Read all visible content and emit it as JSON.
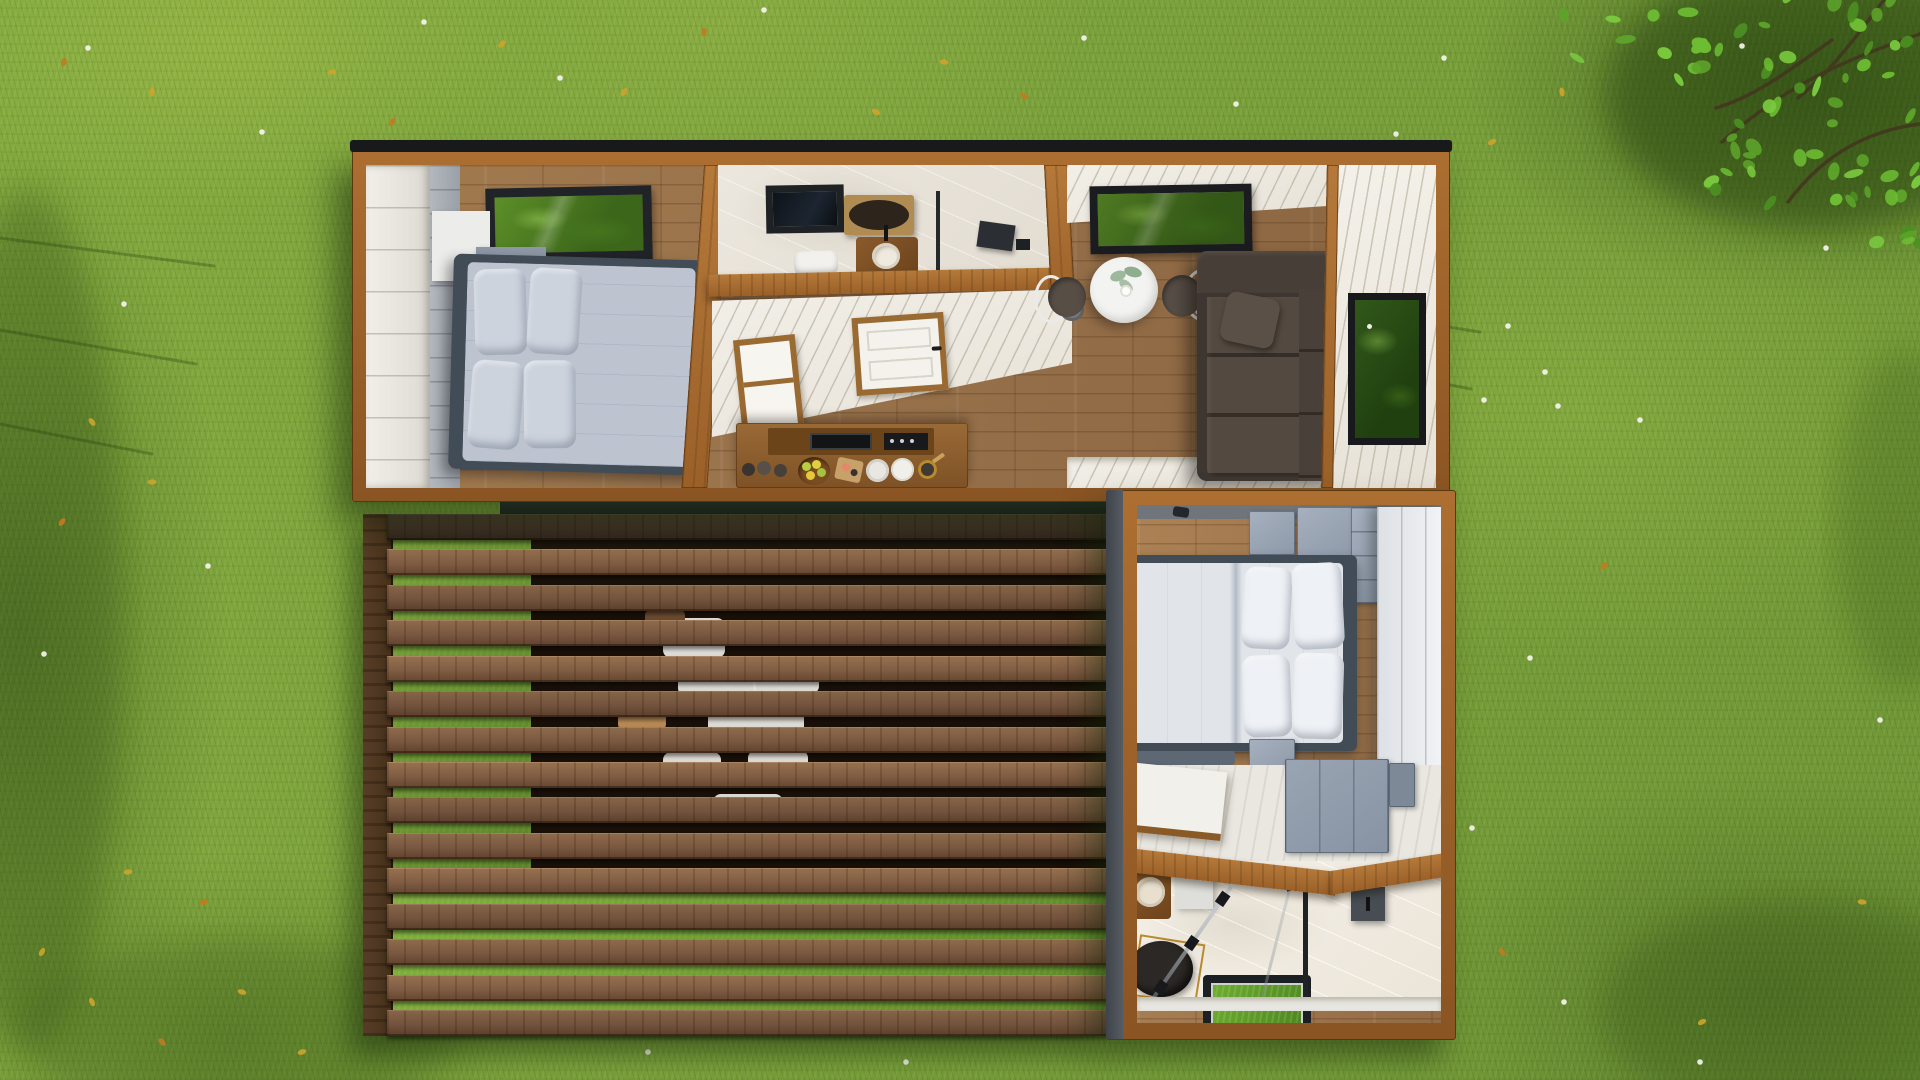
{
  "scene": {
    "view": "top-down aerial 3d architectural render",
    "setting": "green grass lawn with tree canopy at top-right, scattered white flowers and fallen yellow leaves",
    "buildings": [
      "main tiny-house module",
      "annex bedroom-bathroom module",
      "wood slatted pergola deck"
    ]
  },
  "labels": {
    "lawn": "grass lawn",
    "main_module": "main tiny house module",
    "bedroom1": "main bedroom with double bed and skylight",
    "bathroom1": "bathroom with mirror, washbasin, toilet and shower",
    "hallway": "hallway and kitchen with entry door",
    "kitchen_counter": "kitchen counter with cooktop, fruit bowl and plates",
    "dining": "dining area with round table, two chairs and skylight",
    "living": "living area with corner sofa and window",
    "annex_module": "annex module",
    "bedroom2": "annex bedroom with double bed, wardrobe and cabinets",
    "nook": "study nook with desk and cabinet",
    "bathroom2": "annex bathroom with vanity, floor skylight and glass shower",
    "pergola": "slatted wood pergola over deck",
    "canopy": "tree canopy",
    "flowers": "white lawn flowers",
    "leaves": "fallen yellow leaves"
  },
  "main_module": {
    "rooms": [
      {
        "name": "bedroom",
        "furniture": [
          "double bed with grey bedding",
          "four grey pillows",
          "white wardrobe wall",
          "wall shelf unit",
          "roof skylight"
        ]
      },
      {
        "name": "bathroom",
        "furniture": [
          "skylight",
          "framed round mirror",
          "wood washbasin counter",
          "toilet",
          "black shower set"
        ]
      },
      {
        "name": "hallway-kitchen",
        "furniture": [
          "white entry door",
          "white window",
          "kitchen counter with black cooktop",
          "fruit bowl",
          "cutting board",
          "plates",
          "jars",
          "pan"
        ]
      },
      {
        "name": "dining",
        "furniture": [
          "round white table",
          "green plant",
          "two bentwood chairs with dark seats",
          "skylight window"
        ]
      },
      {
        "name": "living",
        "furniture": [
          "dark brown corner sofa",
          "accent cushion",
          "black framed window"
        ]
      }
    ]
  },
  "annex_module": {
    "rooms": [
      {
        "name": "bedroom",
        "furniture": [
          "double bed with white duvet",
          "four white pillows",
          "white wardrobe",
          "blue-grey cabinets",
          "nightstand",
          "foot bench"
        ]
      },
      {
        "name": "study-nook",
        "furniture": [
          "white desk with wood trim",
          "blue-grey cabinet"
        ]
      },
      {
        "name": "bathroom",
        "furniture": [
          "wood vanity with round basin",
          "white column",
          "round dark table with gold frame",
          "floor skylight showing grass",
          "glass shower screen",
          "shower column",
          "grey wall cabinet"
        ]
      }
    ]
  },
  "pergola": {
    "slat_count": 15,
    "slat_height_px": 26,
    "area_height_px": 522,
    "material": "walnut wood slats",
    "visible_beneath": [
      "grass at left and bottom",
      "shadowed deck",
      "white outdoor furniture set"
    ]
  },
  "lawn": {
    "flowers": [
      [
        88,
        48
      ],
      [
        262,
        132
      ],
      [
        424,
        22
      ],
      [
        560,
        78
      ],
      [
        764,
        10
      ],
      [
        1084,
        38
      ],
      [
        1236,
        104
      ],
      [
        1396,
        134
      ],
      [
        1444,
        58
      ],
      [
        1742,
        46
      ],
      [
        1826,
        248
      ],
      [
        1530,
        658
      ],
      [
        1472,
        828
      ],
      [
        1564,
        1002
      ],
      [
        1700,
        1062
      ],
      [
        124,
        304
      ],
      [
        44,
        654
      ],
      [
        208,
        566
      ],
      [
        1508,
        326
      ],
      [
        1545,
        372
      ],
      [
        1484,
        400
      ],
      [
        1558,
        406
      ],
      [
        648,
        1052
      ],
      [
        906,
        1062
      ],
      [
        1640,
        420
      ],
      [
        1880,
        720
      ]
    ],
    "fallen_leaves": [
      [
        64,
        62
      ],
      [
        152,
        92
      ],
      [
        332,
        72
      ],
      [
        392,
        122
      ],
      [
        502,
        44
      ],
      [
        624,
        92
      ],
      [
        704,
        32
      ],
      [
        876,
        112
      ],
      [
        944,
        62
      ],
      [
        1024,
        96
      ],
      [
        92,
        422
      ],
      [
        152,
        482
      ],
      [
        62,
        522
      ],
      [
        42,
        952
      ],
      [
        92,
        1002
      ],
      [
        162,
        1042
      ],
      [
        242,
        992
      ],
      [
        302,
        1052
      ],
      [
        204,
        902
      ],
      [
        1492,
        142
      ],
      [
        1562,
        92
      ],
      [
        1502,
        952
      ],
      [
        1702,
        1022
      ],
      [
        1862,
        902
      ],
      [
        1604,
        566
      ],
      [
        128,
        872
      ]
    ],
    "canopy_clusters": [
      {
        "x": 1695,
        "y": -10,
        "w": 226,
        "h": 215,
        "count": 46
      },
      {
        "x": 1555,
        "y": -15,
        "w": 170,
        "h": 95,
        "count": 14
      },
      {
        "x": 1845,
        "y": 150,
        "w": 75,
        "h": 110,
        "count": 10
      }
    ]
  },
  "palette": {
    "grass_base": "#7CA63B",
    "grass_light": "#9CC14B",
    "grass_dark": "#4A7423",
    "wood_frame": "#9A6028",
    "wood_floor": "#A27A4F",
    "slat_wood": "#7B5B3E",
    "wall_white": "#F2EFE8",
    "marble": "#EAE5DC",
    "bedding": "#BDC4D0",
    "pillow": "#CCD3DD",
    "headboard_slate": "#414C57",
    "cabinet_blue": "#8E99A9",
    "sofa_brown": "#3E3630",
    "frame_black": "#1E2124",
    "glass_grass": "#5C8F28",
    "table_white": "#F3F3F1",
    "gold": "#B98A2E",
    "flower_white": "#F4F4EE",
    "leaf_yellow": "#CDA42C",
    "leaf_orange": "#C27B1F",
    "canopy_leaf": "#5DA32A"
  }
}
